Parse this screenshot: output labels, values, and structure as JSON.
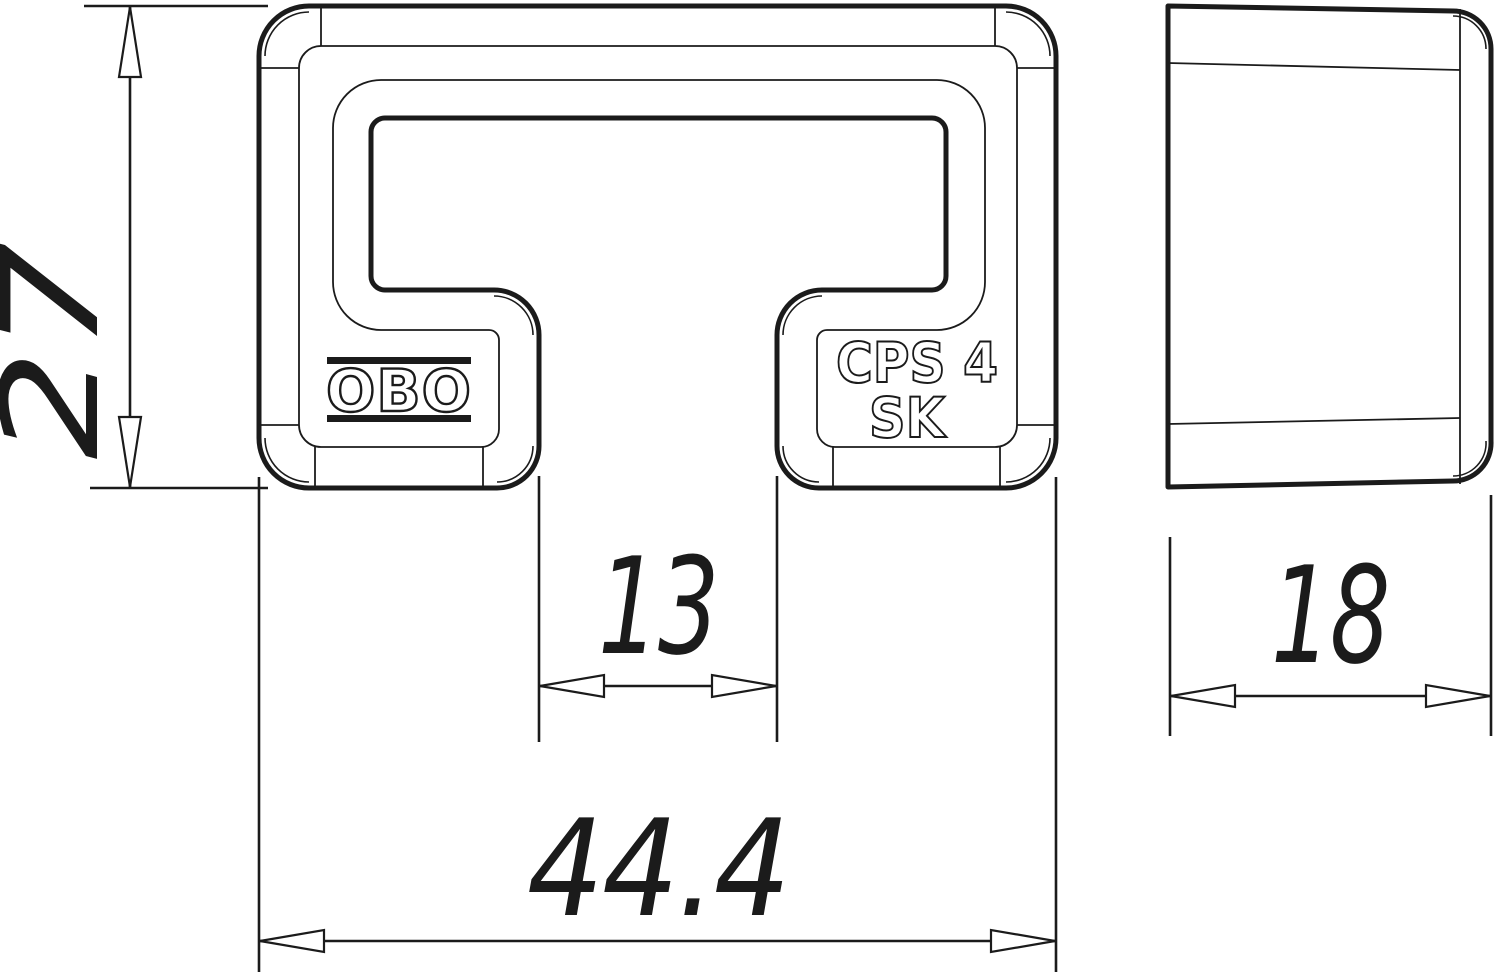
{
  "colors": {
    "line": "#1b1b1b",
    "background": "#ffffff"
  },
  "front_view": {
    "brand_logo": "OBO",
    "marking_line1": "CPS 4",
    "marking_line2": "SK"
  },
  "dimensions": {
    "height": {
      "value": "27",
      "orientation": "vertical"
    },
    "slot_width": {
      "value": "13",
      "orientation": "horizontal"
    },
    "overall_width": {
      "value": "44.4",
      "orientation": "horizontal"
    },
    "depth": {
      "value": "18",
      "orientation": "horizontal"
    }
  }
}
